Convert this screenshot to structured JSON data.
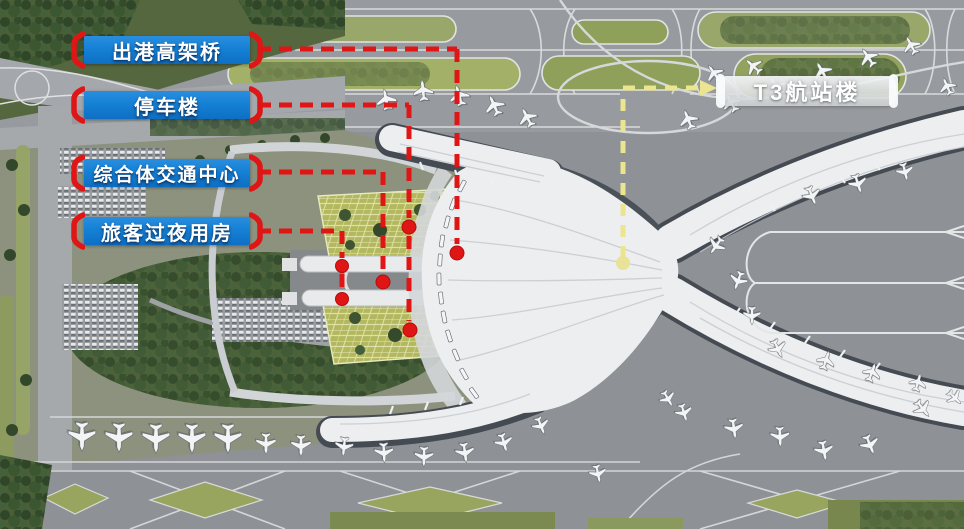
{
  "callouts": {
    "items": [
      {
        "label": "出港高架桥"
      },
      {
        "label": "停车楼"
      },
      {
        "label": "综合体交通中心"
      },
      {
        "label": "旅客过夜用房"
      }
    ],
    "terminal": {
      "label": "T3航站楼"
    }
  },
  "colors": {
    "label_blue": "#1581d5",
    "annotation_red": "#e01515",
    "annotation_yellow": "#ece58f",
    "terminal_label_bg": "#d8dadb",
    "label_text": "#ffffff"
  }
}
